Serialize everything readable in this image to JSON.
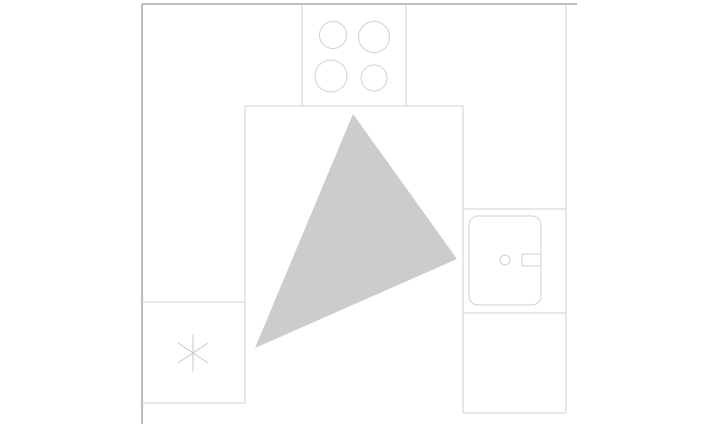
{
  "canvas": {
    "width": 707,
    "height": 424,
    "background": "#ffffff"
  },
  "colors": {
    "wall": "#a6a6a6",
    "line": "#d0d0d0",
    "symbol": "#c6c6c6",
    "triangle": "#cccccc"
  },
  "floor_plan": {
    "title": "kitchen-work-triangle-plan",
    "legend": {
      "work_triangle_vertices": [
        {
          "appliance": "cooktop",
          "x": 353,
          "y": 114
        },
        {
          "appliance": "sink",
          "x": 457,
          "y": 259
        },
        {
          "appliance": "refrigerator",
          "x": 255,
          "y": 348
        }
      ]
    },
    "shapes": [
      {
        "name": "work-triangle",
        "type": "polygon",
        "attrs": {
          "points": "353,114 457,259 255,348",
          "fill": "triangle",
          "stroke": "none"
        }
      },
      {
        "name": "wall-top",
        "type": "line",
        "attrs": {
          "x1": 142,
          "y1": 4,
          "x2": 577,
          "y2": 4,
          "stroke": "wall",
          "stroke-width": 1.5
        }
      },
      {
        "name": "wall-left",
        "type": "line",
        "attrs": {
          "x1": 142,
          "y1": 4,
          "x2": 142,
          "y2": 424,
          "stroke": "wall",
          "stroke-width": 1.5
        }
      },
      {
        "name": "wall-right",
        "type": "line",
        "attrs": {
          "x1": 566,
          "y1": 4,
          "x2": 566,
          "y2": 413,
          "stroke": "line",
          "stroke-width": 1
        }
      },
      {
        "name": "cooktop-cabinet-left-edge",
        "type": "line",
        "attrs": {
          "x1": 302,
          "y1": 4,
          "x2": 302,
          "y2": 106,
          "stroke": "line",
          "stroke-width": 1
        }
      },
      {
        "name": "cooktop-cabinet-right-edge",
        "type": "line",
        "attrs": {
          "x1": 406,
          "y1": 4,
          "x2": 406,
          "y2": 106,
          "stroke": "line",
          "stroke-width": 1
        }
      },
      {
        "name": "counter-inner-top-edge",
        "type": "line",
        "attrs": {
          "x1": 245,
          "y1": 106,
          "x2": 463,
          "y2": 106,
          "stroke": "line",
          "stroke-width": 1
        }
      },
      {
        "name": "counter-inner-left-edge",
        "type": "line",
        "attrs": {
          "x1": 245,
          "y1": 106,
          "x2": 245,
          "y2": 403,
          "stroke": "line",
          "stroke-width": 1
        }
      },
      {
        "name": "counter-inner-right-edge",
        "type": "line",
        "attrs": {
          "x1": 463,
          "y1": 106,
          "x2": 463,
          "y2": 413,
          "stroke": "line",
          "stroke-width": 1
        }
      },
      {
        "name": "sink-cabinet-top-divider",
        "type": "line",
        "attrs": {
          "x1": 463,
          "y1": 209,
          "x2": 566,
          "y2": 209,
          "stroke": "line",
          "stroke-width": 1
        }
      },
      {
        "name": "sink-cabinet-bottom-divider",
        "type": "line",
        "attrs": {
          "x1": 463,
          "y1": 313,
          "x2": 566,
          "y2": 313,
          "stroke": "line",
          "stroke-width": 1
        }
      },
      {
        "name": "counter-right-bottom-edge",
        "type": "line",
        "attrs": {
          "x1": 463,
          "y1": 413,
          "x2": 566,
          "y2": 413,
          "stroke": "line",
          "stroke-width": 1
        }
      },
      {
        "name": "refrigerator-cell-top-edge",
        "type": "line",
        "attrs": {
          "x1": 142,
          "y1": 302,
          "x2": 245,
          "y2": 302,
          "stroke": "line",
          "stroke-width": 1
        }
      },
      {
        "name": "refrigerator-cell-bottom-edge",
        "type": "line",
        "attrs": {
          "x1": 142,
          "y1": 403,
          "x2": 245,
          "y2": 403,
          "stroke": "line",
          "stroke-width": 1
        }
      },
      {
        "name": "burner-top-left",
        "type": "circle",
        "attrs": {
          "cx": 333,
          "cy": 35,
          "r": 13.5,
          "fill": "none",
          "stroke": "line",
          "stroke-width": 1
        }
      },
      {
        "name": "burner-top-right",
        "type": "circle",
        "attrs": {
          "cx": 374,
          "cy": 37,
          "r": 15.5,
          "fill": "none",
          "stroke": "line",
          "stroke-width": 1
        }
      },
      {
        "name": "burner-bottom-left",
        "type": "circle",
        "attrs": {
          "cx": 331,
          "cy": 76,
          "r": 16,
          "fill": "none",
          "stroke": "line",
          "stroke-width": 1
        }
      },
      {
        "name": "burner-bottom-right",
        "type": "circle",
        "attrs": {
          "cx": 374,
          "cy": 78,
          "r": 13,
          "fill": "none",
          "stroke": "line",
          "stroke-width": 1
        }
      },
      {
        "name": "sink-basin",
        "type": "rect",
        "attrs": {
          "x": 469,
          "y": 216,
          "width": 72,
          "height": 89,
          "rx": 9,
          "ry": 9,
          "fill": "none",
          "stroke": "line",
          "stroke-width": 1
        }
      },
      {
        "name": "sink-drain",
        "type": "circle",
        "attrs": {
          "cx": 505,
          "cy": 260,
          "r": 5,
          "fill": "none",
          "stroke": "line",
          "stroke-width": 1
        }
      },
      {
        "name": "sink-faucet",
        "type": "rect",
        "attrs": {
          "x": 522,
          "y": 254,
          "width": 19,
          "height": 12,
          "fill": "none",
          "stroke": "line",
          "stroke-width": 1
        }
      },
      {
        "name": "refrigerator-asterisk-vertical",
        "type": "line",
        "attrs": {
          "x1": 193,
          "y1": 334.5,
          "x2": 193,
          "y2": 371.5,
          "stroke": "symbol",
          "stroke-width": 1
        }
      },
      {
        "name": "refrigerator-asterisk-diagonal-down",
        "type": "line",
        "attrs": {
          "x1": 178,
          "y1": 343,
          "x2": 208,
          "y2": 363,
          "stroke": "symbol",
          "stroke-width": 1
        }
      },
      {
        "name": "refrigerator-asterisk-diagonal-up",
        "type": "line",
        "attrs": {
          "x1": 178,
          "y1": 363,
          "x2": 208,
          "y2": 343,
          "stroke": "symbol",
          "stroke-width": 1
        }
      }
    ]
  }
}
